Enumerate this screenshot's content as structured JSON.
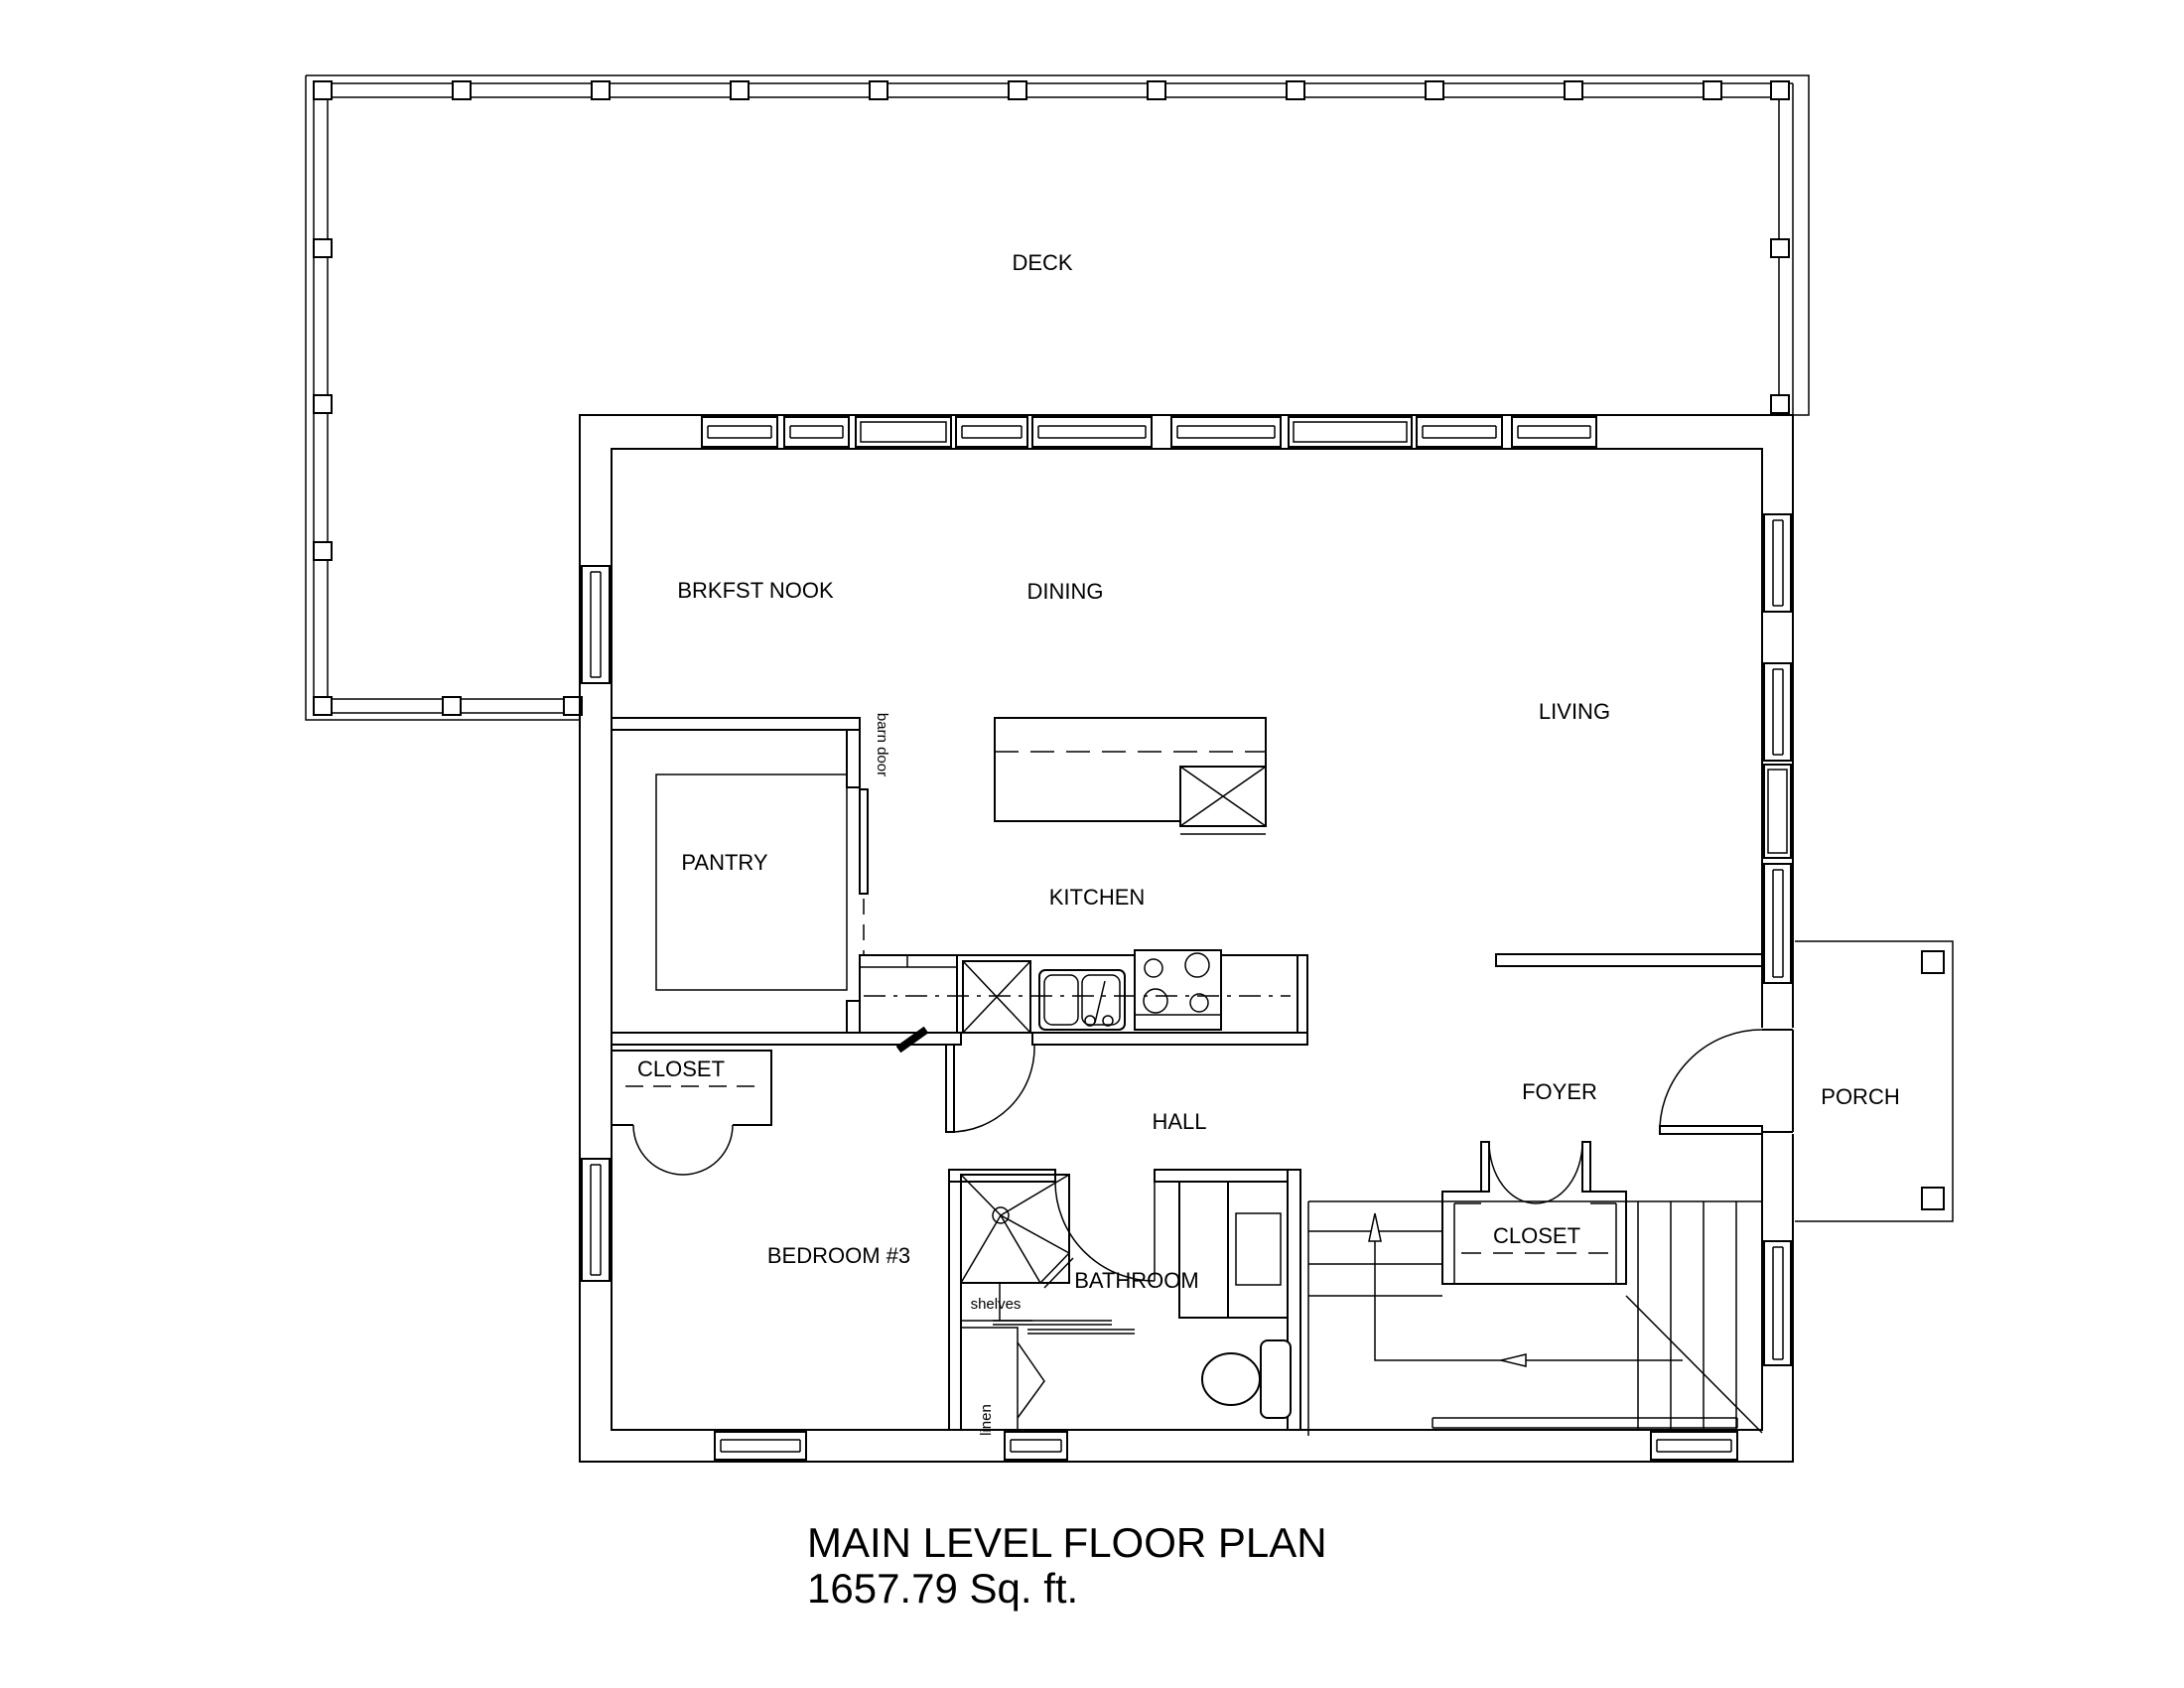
{
  "drawing": {
    "title_line1": "MAIN LEVEL FLOOR PLAN",
    "title_line2": "1657.79 Sq. ft."
  },
  "room_labels": {
    "deck": "DECK",
    "brkfst_nook": "BRKFST NOOK",
    "dining": "DINING",
    "living": "LIVING",
    "pantry": "PANTRY",
    "kitchen": "KITCHEN",
    "bedroom_closet": "CLOSET",
    "bedroom3": "BEDROOM #3",
    "hall": "HALL",
    "bathroom": "BATHROOM",
    "foyer": "FOYER",
    "stair_closet": "CLOSET",
    "porch": "PORCH"
  },
  "annotations": {
    "barn_door": "barn door",
    "shelves": "shelves",
    "linen": "linen"
  },
  "colors": {
    "line": "#000000",
    "background": "#ffffff"
  }
}
